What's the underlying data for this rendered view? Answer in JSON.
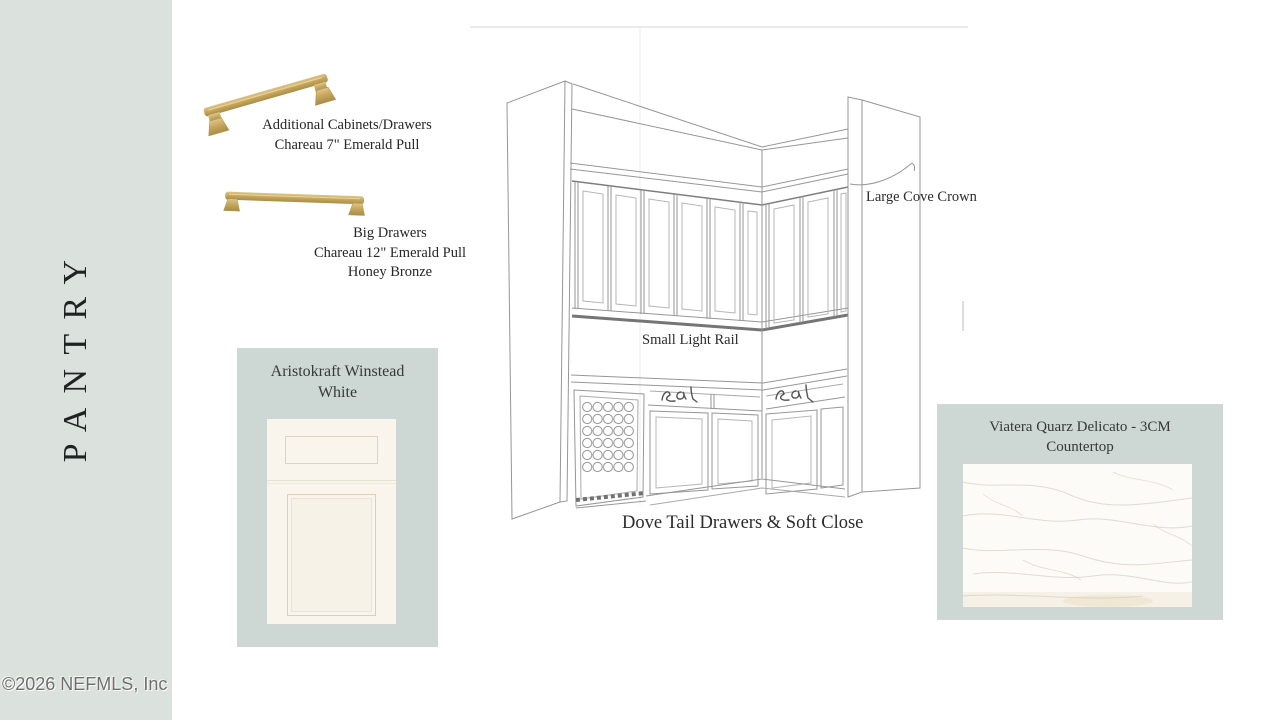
{
  "board": {
    "vertical_title": "PANTRY",
    "copyright": "©2026 NEFMLS, Inc"
  },
  "hardware_small": {
    "line1": "Additional Cabinets/Drawers",
    "line2": "Chareau 7\" Emerald Pull"
  },
  "hardware_big": {
    "line1": "Big Drawers",
    "line2": "Chareau 12\" Emerald Pull",
    "line3": "Honey Bronze"
  },
  "cabinet_panel": {
    "title_line1": "Aristokraft Winstead",
    "title_line2": "White"
  },
  "countertop_panel": {
    "title_line1": "Viatera Quarz Delicato - 3CM",
    "title_line2": "Countertop"
  },
  "sketch_labels": {
    "crown": "Large Cove Crown",
    "light_rail": "Small Light Rail",
    "drawers": "Dove Tail Drawers & Soft Close"
  },
  "colors": {
    "sidebar_bg": "#dbe1dc",
    "panel_bg": "#cdd7d3",
    "brass": "#c8a85e",
    "ink": "#2b2b2b"
  }
}
